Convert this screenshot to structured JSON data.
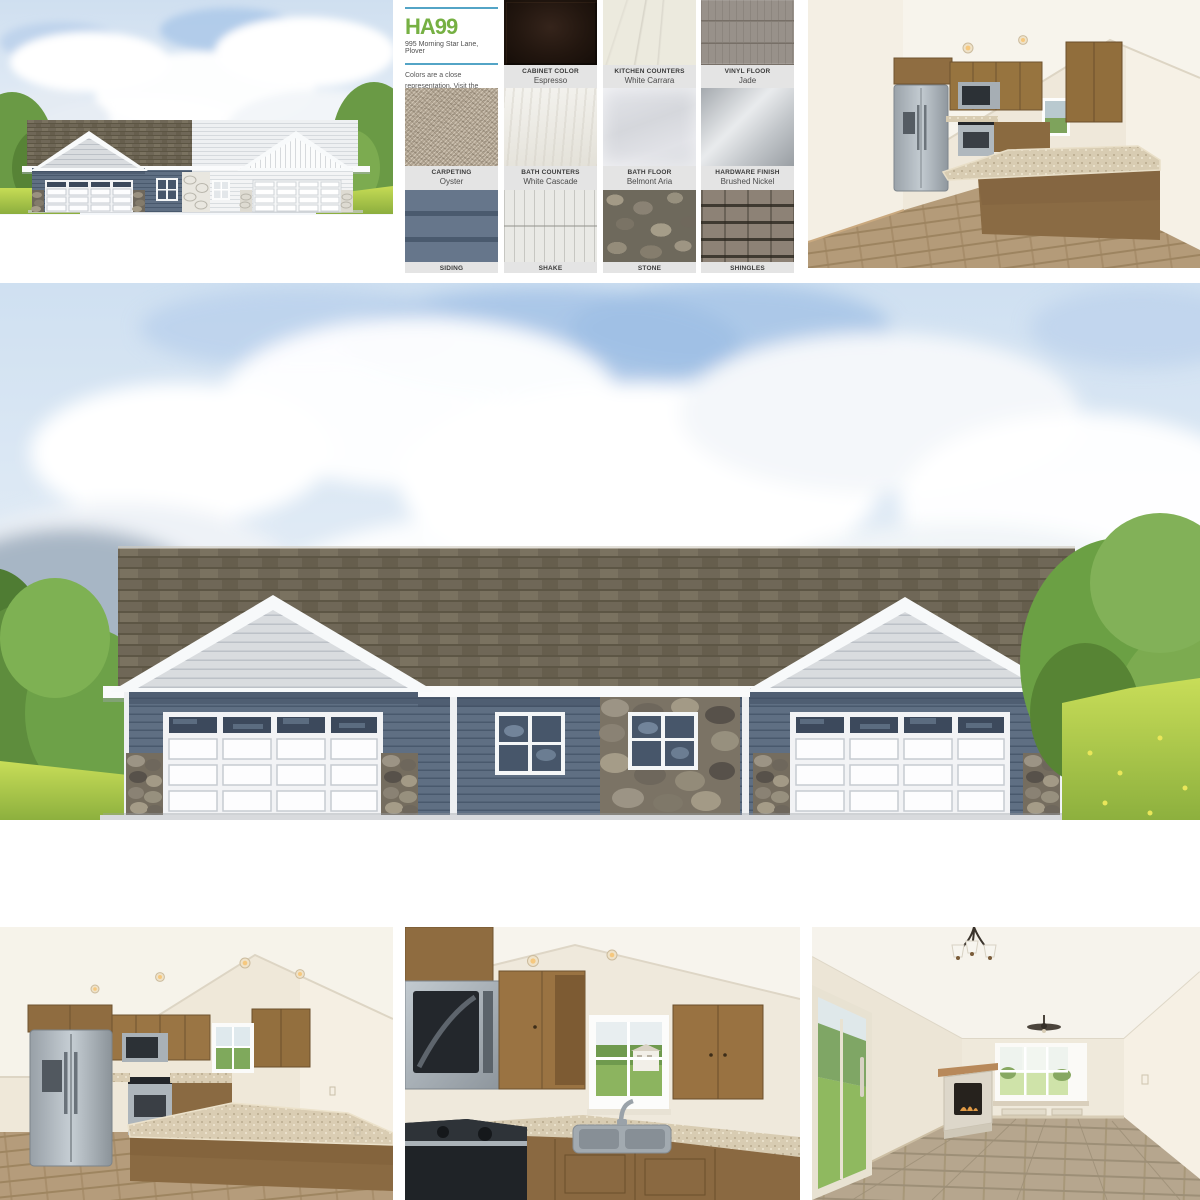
{
  "design_board": {
    "code": "HA99",
    "address": "995 Morning Star Lane, Plover",
    "disclaimer": "Colors are a close representation. Visit the Denyon Homes Design Center to view actual samples.",
    "colors": {
      "accent_green": "#76b043",
      "rule_blue": "#53a4c6",
      "label_bg": "#e4e4e4"
    },
    "swatches": [
      {
        "title": "CABINET COLOR",
        "value": "Espresso",
        "hex": "#22160f"
      },
      {
        "title": "KITCHEN COUNTERS",
        "value": "White Carrara",
        "hex": "#eceade"
      },
      {
        "title": "VINYL FLOOR",
        "value": "Jade",
        "hex": "#98918a"
      },
      {
        "title": "CARPETING",
        "value": "Oyster",
        "hex": "#b2a593"
      },
      {
        "title": "BATH COUNTERS",
        "value": "White Cascade",
        "hex": "#e9e7df"
      },
      {
        "title": "BATH FLOOR",
        "value": "Belmont Aria",
        "hex": "#dbdde2"
      },
      {
        "title": "HARDWARE FINISH",
        "value": "Brushed Nickel",
        "hex": "#c3c7cb"
      },
      {
        "title": "SIDING",
        "hex": "#5d6d80"
      },
      {
        "title": "SHAKE",
        "hex": "#e9e9e5"
      },
      {
        "title": "STONE",
        "hex": "#8a8574"
      },
      {
        "title": "SHINGLES",
        "hex": "#8d8276"
      }
    ]
  }
}
